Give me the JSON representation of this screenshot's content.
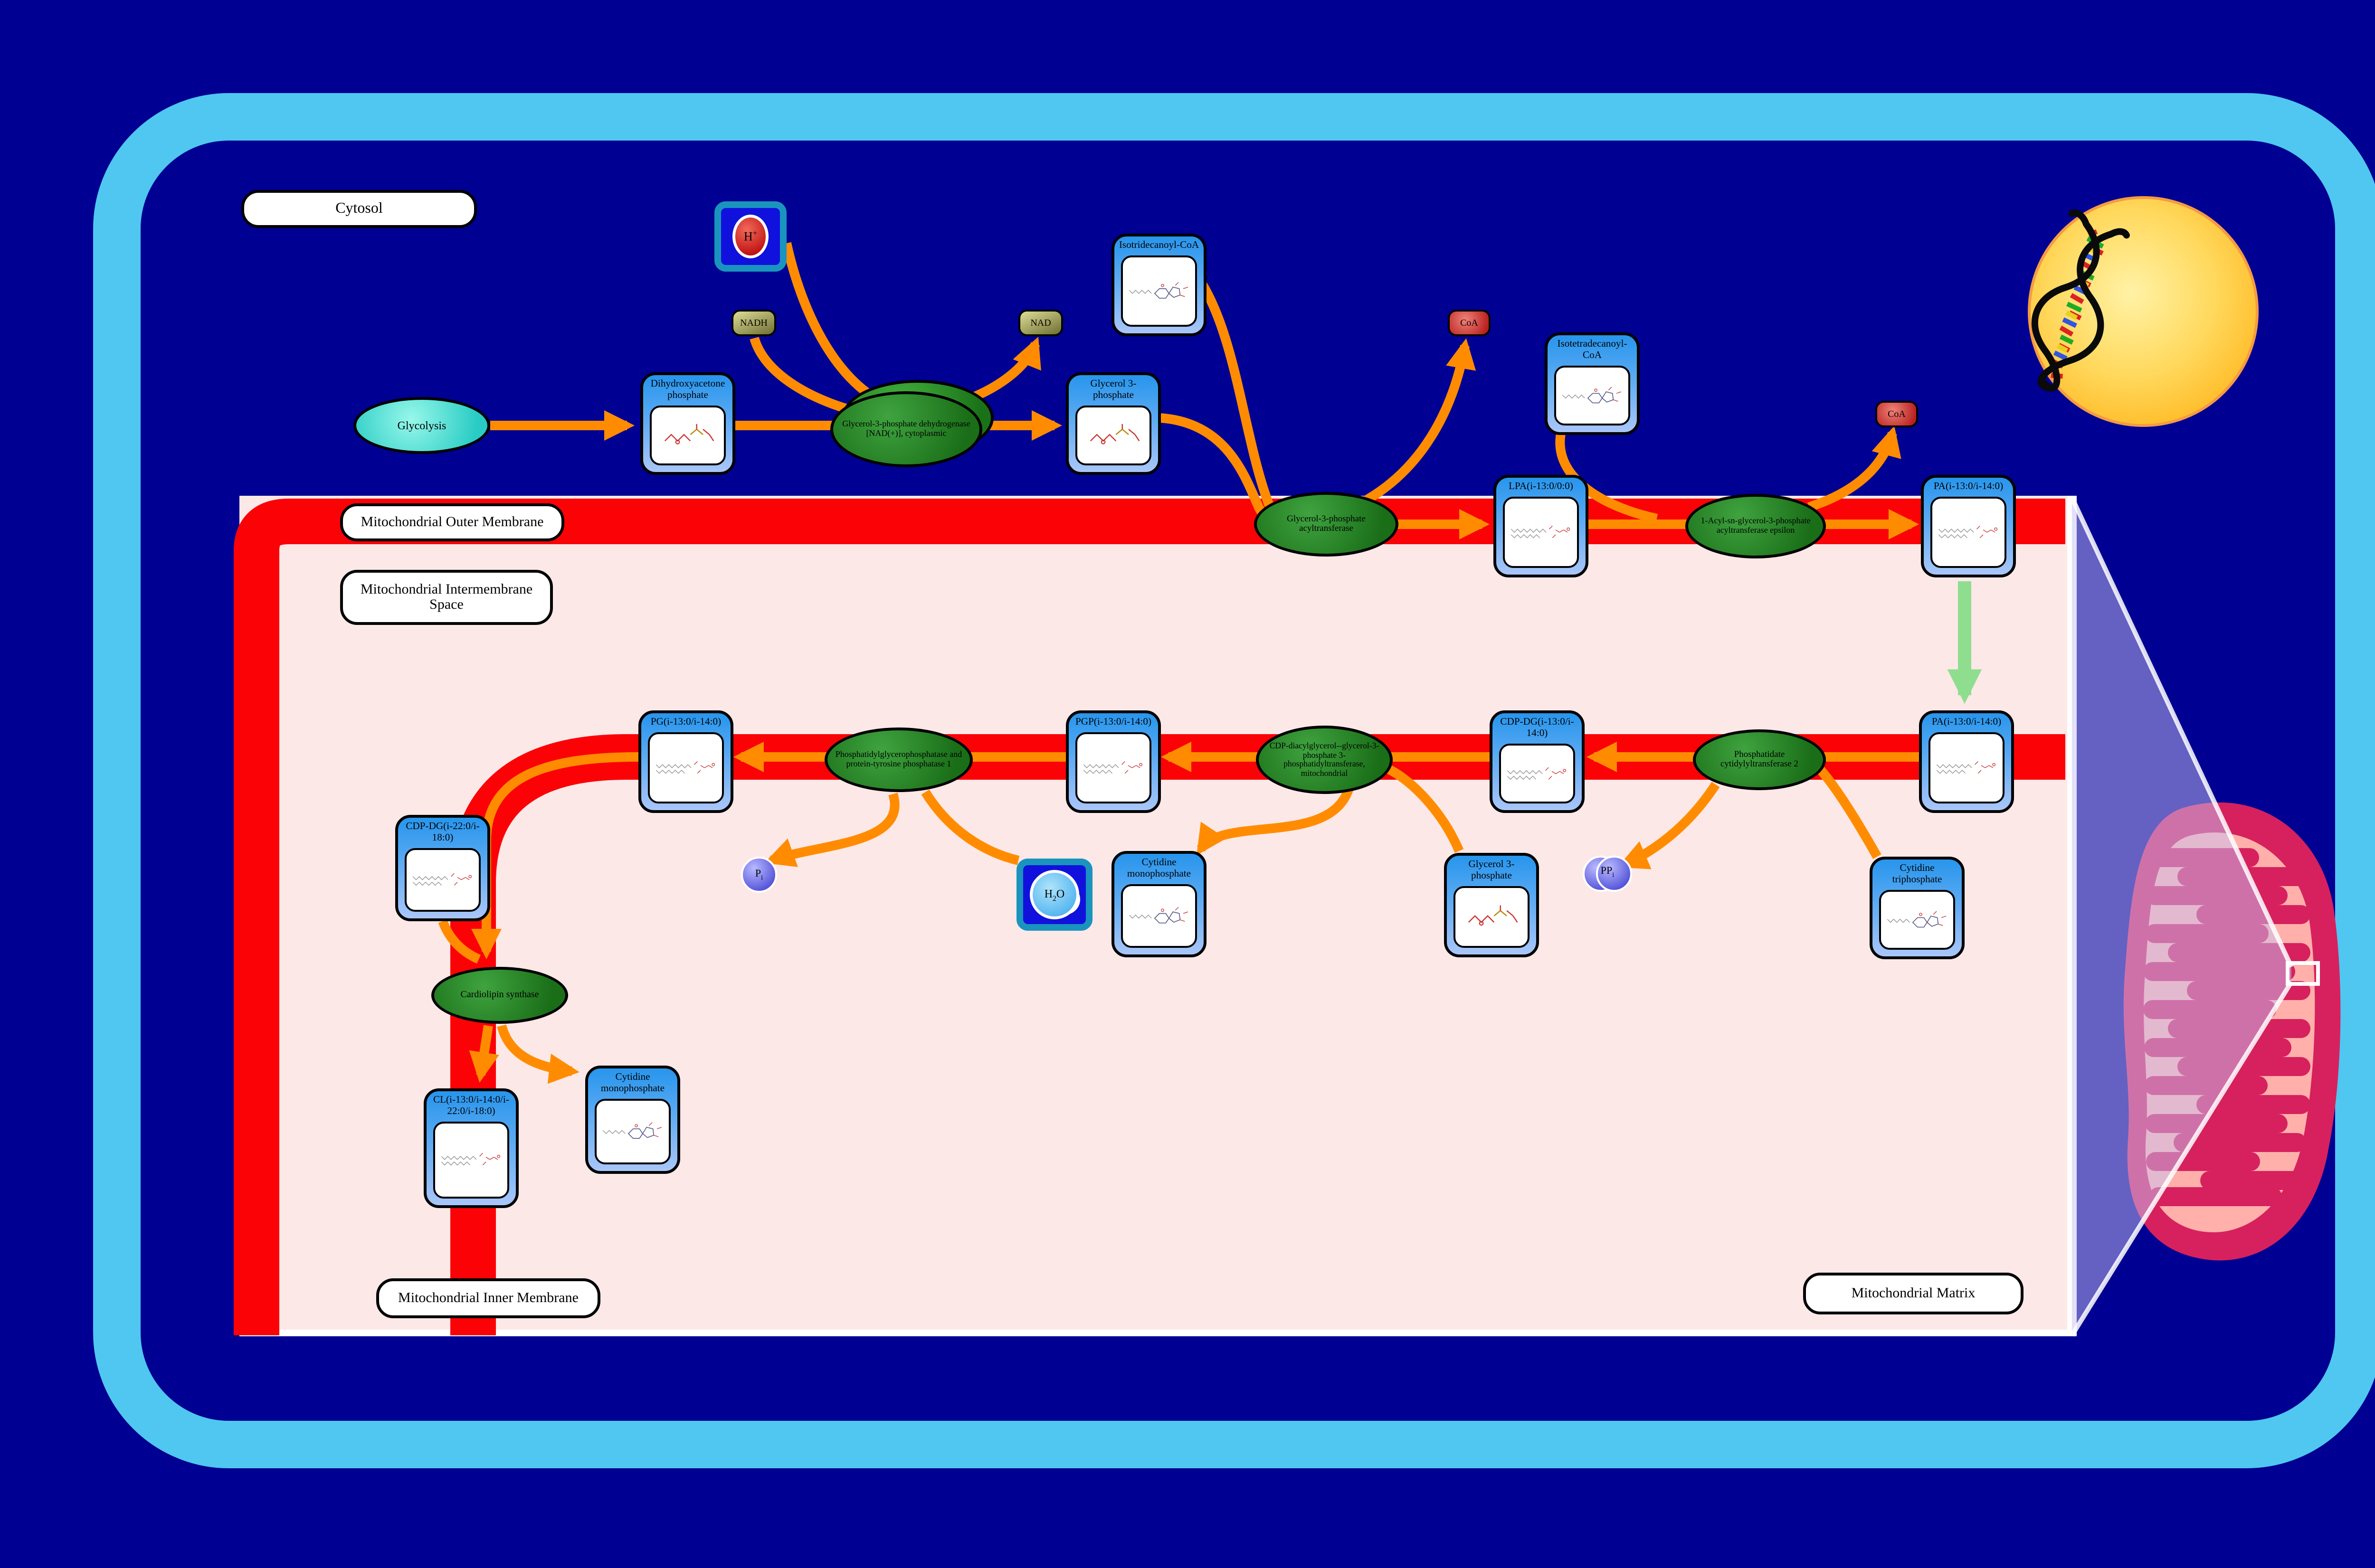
{
  "regions": {
    "cytosol": "Cytosol",
    "outer_membrane": "Mitochondrial Outer Membrane",
    "intermembrane_space": "Mitochondrial Intermembrane Space",
    "inner_membrane": "Mitochondrial Inner Membrane",
    "matrix": "Mitochondrial Matrix"
  },
  "pathway": {
    "source": {
      "label": "Glycolysis"
    },
    "metabolites": [
      {
        "id": "dhap",
        "label": "Dihydroxyacetone phosphate"
      },
      {
        "id": "g3p-cytosol",
        "label": "Glycerol 3-phosphate"
      },
      {
        "id": "isotridecanoyl-coa",
        "label": "Isotridecanoyl-CoA"
      },
      {
        "id": "lpa",
        "label": "LPA(i-13:0/0:0)"
      },
      {
        "id": "isotetradecanoyl-coa",
        "label": "Isotetradecanoyl-CoA"
      },
      {
        "id": "pa-outer",
        "label": "PA(i-13:0/i-14:0)"
      },
      {
        "id": "pa-inner",
        "label": "PA(i-13:0/i-14:0)"
      },
      {
        "id": "ctp",
        "label": "Cytidine triphosphate"
      },
      {
        "id": "cdp-dg-1",
        "label": "CDP-DG(i-13:0/i-14:0)"
      },
      {
        "id": "g3p-matrix",
        "label": "Glycerol 3-phosphate"
      },
      {
        "id": "pgp",
        "label": "PGP(i-13:0/i-14:0)"
      },
      {
        "id": "cmp-1",
        "label": "Cytidine monophosphate"
      },
      {
        "id": "pg",
        "label": "PG(i-13:0/i-14:0)"
      },
      {
        "id": "cdp-dg-2",
        "label": "CDP-DG(i-22:0/i-18:0)"
      },
      {
        "id": "cl",
        "label": "CL(i-13:0/i-14:0/i-22:0/i-18:0)"
      },
      {
        "id": "cmp-2",
        "label": "Cytidine monophosphate"
      }
    ],
    "enzymes": [
      {
        "id": "gpdh",
        "label": "Glycerol-3-phosphate dehydrogenase [NAD(+)], cytoplasmic"
      },
      {
        "id": "gpat",
        "label": "Glycerol-3-phosphate acyltransferase"
      },
      {
        "id": "agpat-epsilon",
        "label": "1-Acyl-sn-glycerol-3-phosphate acyltransferase epsilon"
      },
      {
        "id": "pct2",
        "label": "Phosphatidate cytidylyltransferase 2"
      },
      {
        "id": "cdp-dg-transferase",
        "label": "CDP-diacylglycerol--glycerol-3-phosphate 3-phosphatidyltransferase, mitochondrial"
      },
      {
        "id": "pgp-phosphatase",
        "label": "Phosphatidylglycerophosphatase and protein-tyrosine phosphatase 1"
      },
      {
        "id": "cardiolipin-synthase",
        "label": "Cardiolipin synthase"
      }
    ],
    "cofactors": [
      {
        "id": "nadh",
        "label": "NADH"
      },
      {
        "id": "nad",
        "label": "NAD"
      },
      {
        "id": "coa-1",
        "label": "CoA"
      },
      {
        "id": "coa-2",
        "label": "CoA"
      }
    ],
    "small_molecules": {
      "h_plus": {
        "pre": "H",
        "sup": "+"
      },
      "h2o": {
        "pre": "H",
        "sub": "2",
        "post": "O"
      },
      "ppi": {
        "pre": "PP",
        "sub": "i"
      },
      "pi": {
        "pre": "P",
        "sub": "i"
      }
    }
  },
  "colors": {
    "background": "#000092",
    "cell_border": "#4fc7f0",
    "membrane_red": "#fb0207",
    "matrix_pink": "#fde8e8",
    "arrow_orange": "#ff8c00",
    "transport_green": "#8fde8f",
    "enzyme_green": "#1a6e18",
    "metabolite_blue": "#2795ec",
    "nucleus_yellow": "#ffc62e",
    "mitochondrion_crimson": "#d6215e",
    "mitochondrion_salmon": "#ffb0aa"
  }
}
